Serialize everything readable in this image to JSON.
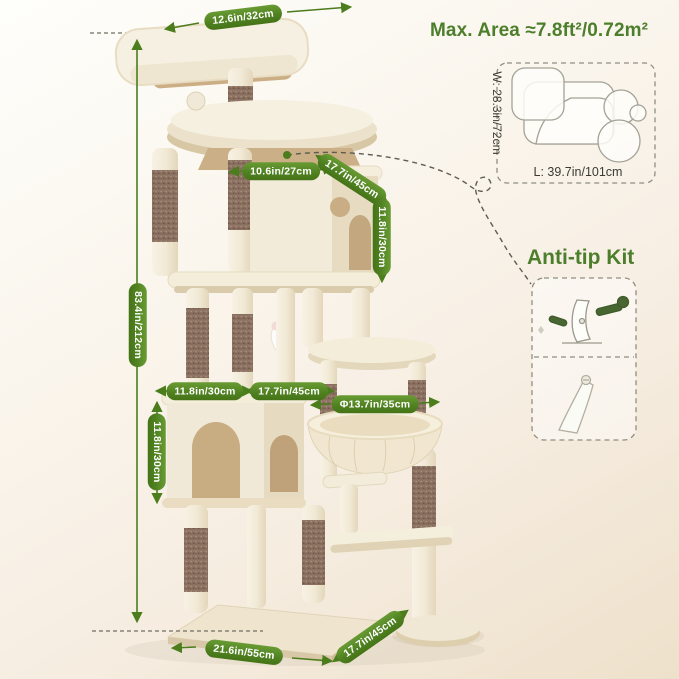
{
  "header": {
    "max_area": "Max. Area ≈7.8ft²/0.72m²"
  },
  "footprint_diagram": {
    "width_label": "W: 28.3in/72cm",
    "length_label": "L: 39.7in/101cm"
  },
  "anti_tip": {
    "title": "Anti-tip Kit"
  },
  "dimensions": {
    "top_perch_width": "12.6in/32cm",
    "total_height": "83.4in/212cm",
    "upper_shelf_width": "10.6in/27cm",
    "upper_condo_depth": "17.7in/45cm",
    "upper_condo_height": "11.8in/30cm",
    "lower_condo_width": "11.8in/30cm",
    "middle_depth": "17.7in/45cm",
    "basket_diameter": "Φ13.7in/35cm",
    "lower_condo_height": "11.8in/30cm",
    "base_width": "21.6in/55cm",
    "base_depth": "17.7in/45cm"
  },
  "colors": {
    "accent_green": "#4b7d1c",
    "pill_green": "#4e8020",
    "text_green": "#4c7e2b",
    "plush_beige": "#f4edda",
    "sisal_brown": "#8c7161"
  }
}
